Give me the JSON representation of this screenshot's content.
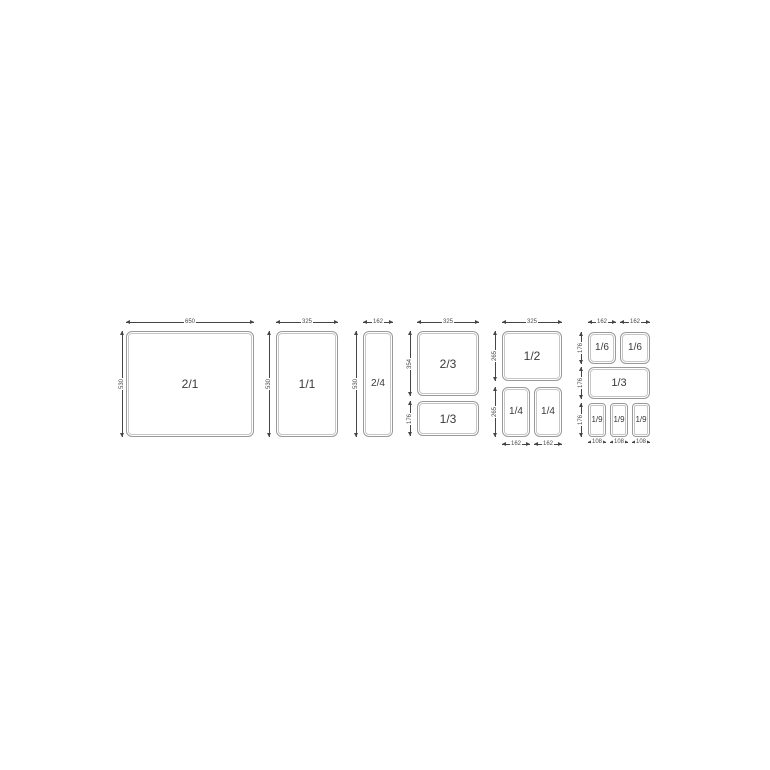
{
  "diagram": {
    "title": "Gastronorm pan size chart",
    "colors": {
      "background": "#ffffff",
      "dimension_line": "#454545",
      "pan_outline": "#9a9a9a",
      "pan_inner_outline": "#c6c6c6",
      "pan_label_text": "#3a3a3a",
      "dimension_text": "#4a4a4a"
    },
    "pans": [
      {
        "id": "gn-2-1",
        "label": "2/1",
        "x": 126,
        "y": 331,
        "w": 128,
        "h": 106
      },
      {
        "id": "gn-1-1",
        "label": "1/1",
        "x": 276,
        "y": 331,
        "w": 62,
        "h": 106
      },
      {
        "id": "gn-2-4",
        "label": "2/4",
        "x": 363,
        "y": 331,
        "w": 30,
        "h": 106
      },
      {
        "id": "gn-2-3",
        "label": "2/3",
        "x": 417,
        "y": 331,
        "w": 62,
        "h": 65
      },
      {
        "id": "gn-1-3-a",
        "label": "1/3",
        "x": 417,
        "y": 401,
        "w": 62,
        "h": 35
      },
      {
        "id": "gn-1-2",
        "label": "1/2",
        "x": 502,
        "y": 331,
        "w": 60,
        "h": 50
      },
      {
        "id": "gn-1-4-a",
        "label": "1/4",
        "x": 502,
        "y": 387,
        "w": 28,
        "h": 50
      },
      {
        "id": "gn-1-4-b",
        "label": "1/4",
        "x": 534,
        "y": 387,
        "w": 28,
        "h": 50
      },
      {
        "id": "gn-1-6-a",
        "label": "1/6",
        "x": 588,
        "y": 332,
        "w": 28,
        "h": 32
      },
      {
        "id": "gn-1-6-b",
        "label": "1/6",
        "x": 620,
        "y": 332,
        "w": 30,
        "h": 32
      },
      {
        "id": "gn-1-3-b",
        "label": "1/3",
        "x": 588,
        "y": 367,
        "w": 62,
        "h": 32
      },
      {
        "id": "gn-1-9-a",
        "label": "1/9",
        "x": 588,
        "y": 403,
        "w": 18,
        "h": 34
      },
      {
        "id": "gn-1-9-b",
        "label": "1/9",
        "x": 610,
        "y": 403,
        "w": 18,
        "h": 34
      },
      {
        "id": "gn-1-9-c",
        "label": "1/9",
        "x": 632,
        "y": 403,
        "w": 18,
        "h": 34
      }
    ],
    "dimensions": [
      {
        "id": "width-650",
        "label": "650",
        "orientation": "h",
        "x": 126,
        "y": 322,
        "length": 128
      },
      {
        "id": "depth-530-a",
        "label": "530",
        "orientation": "v",
        "x": 122,
        "y": 331,
        "length": 106
      },
      {
        "id": "width-325-a",
        "label": "325",
        "orientation": "h",
        "x": 276,
        "y": 322,
        "length": 62
      },
      {
        "id": "depth-530-b",
        "label": "530",
        "orientation": "v",
        "x": 269,
        "y": 331,
        "length": 106
      },
      {
        "id": "width-162-a",
        "label": "162",
        "orientation": "h",
        "x": 363,
        "y": 322,
        "length": 30
      },
      {
        "id": "depth-530-c",
        "label": "530",
        "orientation": "v",
        "x": 356,
        "y": 331,
        "length": 106
      },
      {
        "id": "width-325-b",
        "label": "325",
        "orientation": "h",
        "x": 417,
        "y": 322,
        "length": 62
      },
      {
        "id": "depth-354",
        "label": "354",
        "orientation": "v",
        "x": 410,
        "y": 331,
        "length": 65
      },
      {
        "id": "depth-176-a",
        "label": "176",
        "orientation": "v",
        "x": 410,
        "y": 401,
        "length": 35
      },
      {
        "id": "width-325-c",
        "label": "325",
        "orientation": "h",
        "x": 502,
        "y": 322,
        "length": 60
      },
      {
        "id": "depth-265-a",
        "label": "265",
        "orientation": "v",
        "x": 495,
        "y": 331,
        "length": 50
      },
      {
        "id": "depth-265-b",
        "label": "265",
        "orientation": "v",
        "x": 495,
        "y": 387,
        "length": 50
      },
      {
        "id": "width-162-b",
        "label": "162",
        "orientation": "h",
        "x": 502,
        "y": 444,
        "length": 28
      },
      {
        "id": "width-162-c",
        "label": "162",
        "orientation": "h",
        "x": 534,
        "y": 444,
        "length": 28
      },
      {
        "id": "width-162-d",
        "label": "162",
        "orientation": "h",
        "x": 588,
        "y": 322,
        "length": 28
      },
      {
        "id": "width-162-e",
        "label": "162",
        "orientation": "h",
        "x": 620,
        "y": 322,
        "length": 30
      },
      {
        "id": "depth-176-b",
        "label": "176",
        "orientation": "v",
        "x": 581,
        "y": 332,
        "length": 32
      },
      {
        "id": "depth-176-c",
        "label": "176",
        "orientation": "v",
        "x": 581,
        "y": 367,
        "length": 32
      },
      {
        "id": "depth-176-d",
        "label": "176",
        "orientation": "v",
        "x": 581,
        "y": 403,
        "length": 34
      },
      {
        "id": "width-108-a",
        "label": "108",
        "orientation": "h",
        "x": 588,
        "y": 442,
        "length": 18
      },
      {
        "id": "width-108-b",
        "label": "108",
        "orientation": "h",
        "x": 610,
        "y": 442,
        "length": 18
      },
      {
        "id": "width-108-c",
        "label": "108",
        "orientation": "h",
        "x": 632,
        "y": 442,
        "length": 18
      }
    ]
  }
}
